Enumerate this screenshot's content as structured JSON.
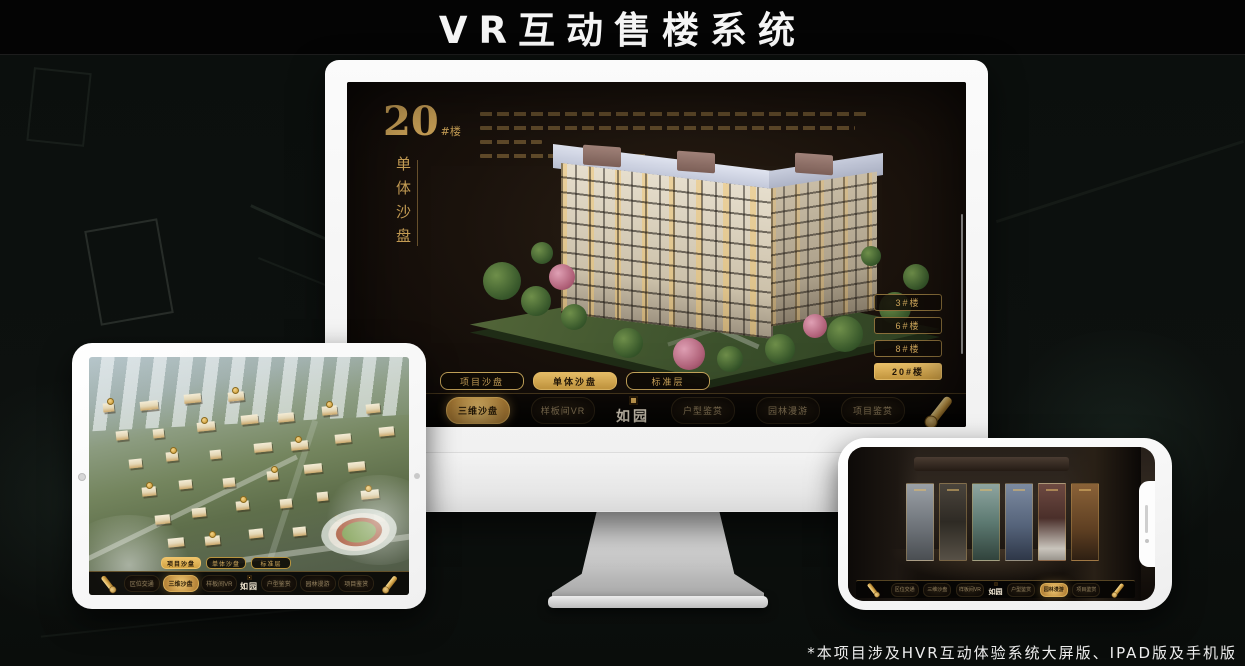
{
  "page": {
    "title": "VR互动售楼系统",
    "footnote": "*本项目涉及HVR互动体验系统大屏版、IPAD版及手机版"
  },
  "colors": {
    "accent_gold": "#d5aa58",
    "screen_background": "#17100a",
    "nav_background": "#0a0705",
    "device_white": "#f7f7f7",
    "title_text": "#f5f5f5"
  },
  "monitor_app": {
    "block_number": "20",
    "block_number_suffix": "#楼",
    "block_subtitle": "单体沙盘",
    "building_buttons": [
      {
        "label": "3#楼",
        "active": false
      },
      {
        "label": "6#楼",
        "active": false
      },
      {
        "label": "8#楼",
        "active": false
      },
      {
        "label": "20#楼",
        "active": true
      }
    ],
    "view_tabs": [
      {
        "label": "项目沙盘",
        "active": false
      },
      {
        "label": "单体沙盘",
        "active": true
      },
      {
        "label": "标准层",
        "active": false
      }
    ],
    "nav_left": [
      {
        "label": "区位交通",
        "active": false
      },
      {
        "label": "三维沙盘",
        "active": true
      },
      {
        "label": "样板间VR",
        "active": false
      }
    ],
    "nav_right": [
      {
        "label": "户型鉴赏",
        "active": false
      },
      {
        "label": "园林漫游",
        "active": false
      },
      {
        "label": "项目鉴赏",
        "active": false
      }
    ],
    "logo": "如园"
  },
  "tablet_app": {
    "view_tabs": [
      {
        "label": "项目沙盘",
        "active": true
      },
      {
        "label": "单体沙盘",
        "active": false
      },
      {
        "label": "标准层",
        "active": false
      }
    ],
    "nav_left": [
      {
        "label": "区位交通",
        "active": false
      },
      {
        "label": "三维沙盘",
        "active": true
      },
      {
        "label": "样板间VR",
        "active": false
      }
    ],
    "nav_right": [
      {
        "label": "户型鉴赏",
        "active": false
      },
      {
        "label": "园林漫游",
        "active": false
      },
      {
        "label": "项目鉴赏",
        "active": false
      }
    ],
    "logo": "如园"
  },
  "phone_app": {
    "nav_left": [
      {
        "label": "区位交通",
        "active": false
      },
      {
        "label": "三维沙盘",
        "active": false
      },
      {
        "label": "样板间VR",
        "active": false
      }
    ],
    "nav_right": [
      {
        "label": "户型鉴赏",
        "active": false
      },
      {
        "label": "园林漫游",
        "active": true
      },
      {
        "label": "项目鉴赏",
        "active": false
      }
    ],
    "logo": "如园"
  }
}
